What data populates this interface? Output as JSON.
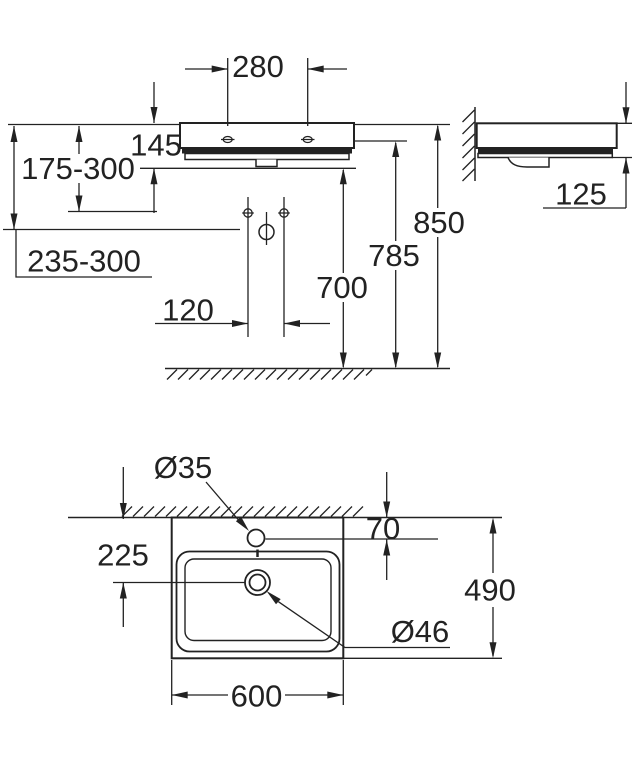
{
  "drawing": {
    "background": "#ffffff",
    "line_color": "#222222",
    "front_view": {
      "tap_hole_spacing": "280",
      "basin_height": "145",
      "waste_height_range": "175-300",
      "supply_height_range": "235-300",
      "supply_spacing": "120",
      "trap_to_floor": "700",
      "underside_to_floor": "785",
      "rim_to_floor": "850"
    },
    "side_view": {
      "front_edge_height": "125"
    },
    "top_view": {
      "tap_hole_diameter": "Ø35",
      "tap_hole_to_wall": "70",
      "drain_to_wall": "225",
      "basin_depth": "490",
      "drain_diameter": "Ø46",
      "basin_width": "600"
    }
  }
}
